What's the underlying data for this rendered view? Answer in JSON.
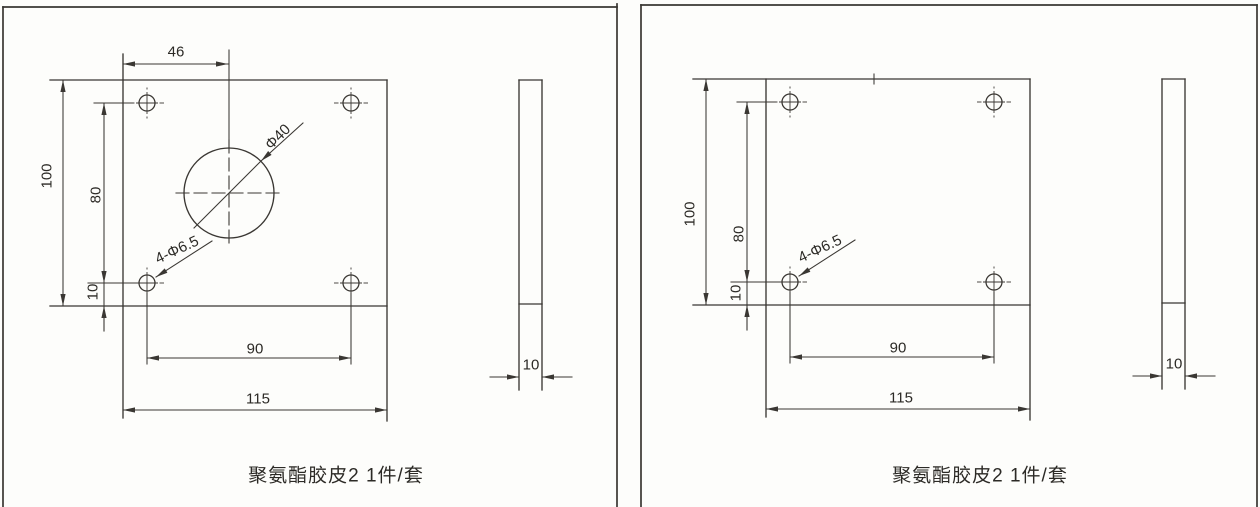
{
  "page": {
    "background": "#fdfdfb",
    "line_color": "#3a3733",
    "text_color": "#2c2a26"
  },
  "left_drawing": {
    "caption": "聚氨酯胶皮2 1件/套",
    "front_view": {
      "dim_top_offset": "46",
      "dim_height": "100",
      "dim_hole_spacing_vertical": "80",
      "dim_hole_edge_offset": "10",
      "dim_hole_spacing_horizontal": "90",
      "dim_width": "115",
      "label_center_hole": "Φ40",
      "label_corner_holes": "4-Φ6.5"
    },
    "side_view": {
      "dim_thickness": "10"
    }
  },
  "right_drawing": {
    "caption": "聚氨酯胶皮2 1件/套",
    "front_view": {
      "dim_height": "100",
      "dim_hole_spacing_vertical": "80",
      "dim_hole_edge_offset": "10",
      "dim_hole_spacing_horizontal": "90",
      "dim_width": "115",
      "label_corner_holes": "4-Φ6.5"
    },
    "side_view": {
      "dim_thickness": "10"
    }
  }
}
